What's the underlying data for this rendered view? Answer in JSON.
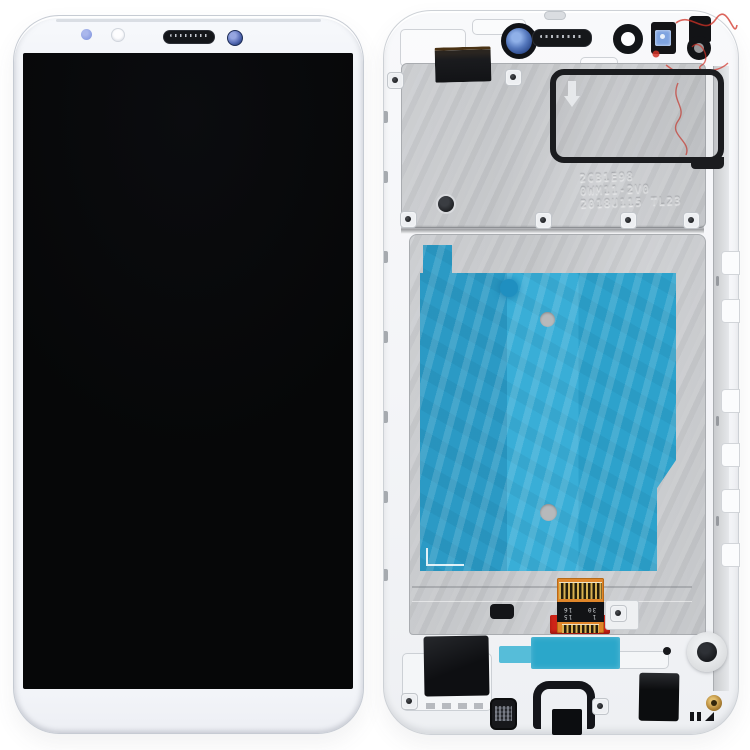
{
  "image": {
    "kind": "product photo on white background",
    "subject_left": "LCD screen and digitizer front view (white, screen off)",
    "subject_right": "LCD assembly back view with white frame, metal plate, blue adhesive film and flex cable"
  },
  "colors": {
    "background": "#ffffff",
    "screen_black": "#060708",
    "plate_gray": "#c1c3c6",
    "film_blue": "#2ea6d1",
    "pad_teal": "#2ba7ca",
    "pad_teal_light": "#56bdd9",
    "flex_orange": "#e0862a",
    "tape_red": "#cf2418",
    "marker_red": "#d23126",
    "lens_blue": "#5578bd",
    "sensor_blue": "#7ea3e0",
    "screw_gold": "#b5883a"
  },
  "back_view": {
    "etched_label": {
      "line1": "2CB1E98",
      "line2": "0WM11-2V0",
      "line3": "2018U115 TL23"
    },
    "flex_marking_left": "15\n16",
    "flex_marking_right": "1\n30"
  }
}
